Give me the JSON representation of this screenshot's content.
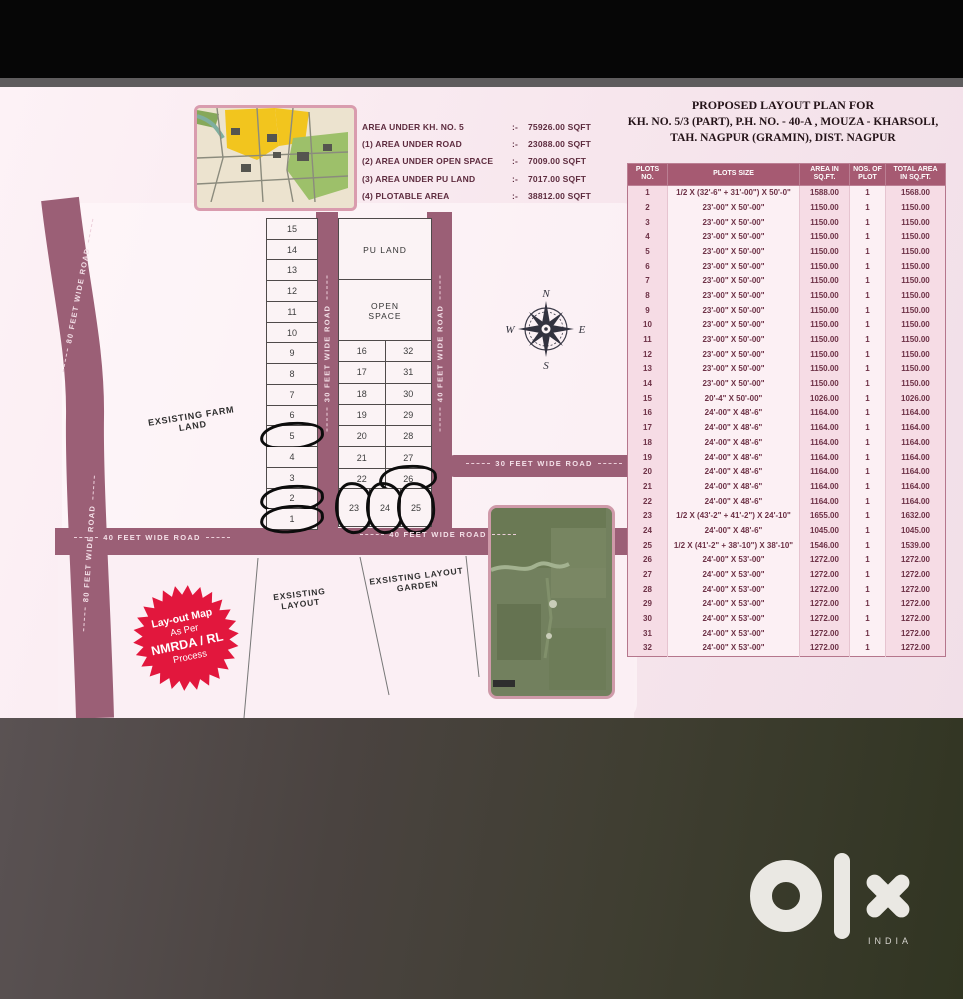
{
  "colors": {
    "road": "#9b5f76",
    "table_header": "#a65a72",
    "badge_red": "#e2173d",
    "plan_background": "#f8e9ef",
    "brand_mark": "#eae8e3"
  },
  "header": {
    "title_line1": "PROPOSED LAYOUT PLAN FOR",
    "title_line2": "KH. NO. 5/3 (PART), P.H. NO. - 40-A , MOUZA - KHARSOLI,",
    "title_line3": "TAH. NAGPUR (GRAMIN), DIST. NAGPUR"
  },
  "area_legend": {
    "sep": ":-",
    "rows": [
      {
        "label": "AREA UNDER KH. NO. 5",
        "value": "75926.00 SQFT"
      },
      {
        "label": "(1) AREA UNDER ROAD",
        "value": "23088.00 SQFT"
      },
      {
        "label": "(2) AREA UNDER OPEN SPACE",
        "value": "7009.00 SQFT"
      },
      {
        "label": "(3) AREA UNDER PU LAND",
        "value": "7017.00 SQFT"
      },
      {
        "label": "(4) PLOTABLE AREA",
        "value": "38812.00 SQFT"
      }
    ]
  },
  "table": {
    "headers": [
      "PLOTS NO.",
      "PLOTS SIZE",
      "AREA IN\nSQ.FT.",
      "NOS. OF\nPLOT",
      "TOTAL AREA\nIN SQ.FT."
    ],
    "rows": [
      [
        "1",
        "1/2 X (32'-6\" + 31'-00\") X 50'-0\"",
        "1588.00",
        "1",
        "1568.00"
      ],
      [
        "2",
        "23'-00\" X 50'-00\"",
        "1150.00",
        "1",
        "1150.00"
      ],
      [
        "3",
        "23'-00\" X 50'-00\"",
        "1150.00",
        "1",
        "1150.00"
      ],
      [
        "4",
        "23'-00\" X 50'-00\"",
        "1150.00",
        "1",
        "1150.00"
      ],
      [
        "5",
        "23'-00\" X 50'-00\"",
        "1150.00",
        "1",
        "1150.00"
      ],
      [
        "6",
        "23'-00\" X 50'-00\"",
        "1150.00",
        "1",
        "1150.00"
      ],
      [
        "7",
        "23'-00\" X 50'-00\"",
        "1150.00",
        "1",
        "1150.00"
      ],
      [
        "8",
        "23'-00\" X 50'-00\"",
        "1150.00",
        "1",
        "1150.00"
      ],
      [
        "9",
        "23'-00\" X 50'-00\"",
        "1150.00",
        "1",
        "1150.00"
      ],
      [
        "10",
        "23'-00\" X 50'-00\"",
        "1150.00",
        "1",
        "1150.00"
      ],
      [
        "11",
        "23'-00\" X 50'-00\"",
        "1150.00",
        "1",
        "1150.00"
      ],
      [
        "12",
        "23'-00\" X 50'-00\"",
        "1150.00",
        "1",
        "1150.00"
      ],
      [
        "13",
        "23'-00\" X 50'-00\"",
        "1150.00",
        "1",
        "1150.00"
      ],
      [
        "14",
        "23'-00\" X 50'-00\"",
        "1150.00",
        "1",
        "1150.00"
      ],
      [
        "15",
        "20'-4\" X 50'-00\"",
        "1026.00",
        "1",
        "1026.00"
      ],
      [
        "16",
        "24'-00\" X 48'-6\"",
        "1164.00",
        "1",
        "1164.00"
      ],
      [
        "17",
        "24'-00\" X 48'-6\"",
        "1164.00",
        "1",
        "1164.00"
      ],
      [
        "18",
        "24'-00\" X 48'-6\"",
        "1164.00",
        "1",
        "1164.00"
      ],
      [
        "19",
        "24'-00\" X 48'-6\"",
        "1164.00",
        "1",
        "1164.00"
      ],
      [
        "20",
        "24'-00\" X 48'-6\"",
        "1164.00",
        "1",
        "1164.00"
      ],
      [
        "21",
        "24'-00\" X 48'-6\"",
        "1164.00",
        "1",
        "1164.00"
      ],
      [
        "22",
        "24'-00\" X 48'-6\"",
        "1164.00",
        "1",
        "1164.00"
      ],
      [
        "23",
        "1/2 X (43'-2\" + 41'-2\") X 24'-10\"",
        "1655.00",
        "1",
        "1632.00"
      ],
      [
        "24",
        "24'-00\" X 48'-6\"",
        "1045.00",
        "1",
        "1045.00"
      ],
      [
        "25",
        "1/2 X (41'-2\" + 38'-10\") X 38'-10\"",
        "1546.00",
        "1",
        "1539.00"
      ],
      [
        "26",
        "24'-00\" X 53'-00\"",
        "1272.00",
        "1",
        "1272.00"
      ],
      [
        "27",
        "24'-00\" X 53'-00\"",
        "1272.00",
        "1",
        "1272.00"
      ],
      [
        "28",
        "24'-00\" X 53'-00\"",
        "1272.00",
        "1",
        "1272.00"
      ],
      [
        "29",
        "24'-00\" X 53'-00\"",
        "1272.00",
        "1",
        "1272.00"
      ],
      [
        "30",
        "24'-00\" X 53'-00\"",
        "1272.00",
        "1",
        "1272.00"
      ],
      [
        "31",
        "24'-00\" X 53'-00\"",
        "1272.00",
        "1",
        "1272.00"
      ],
      [
        "32",
        "24'-00\" X 53'-00\"",
        "1272.00",
        "1",
        "1272.00"
      ]
    ]
  },
  "map": {
    "left_plots": [
      "15",
      "14",
      "13",
      "12",
      "11",
      "10",
      "9",
      "8",
      "7",
      "6",
      "5",
      "4",
      "3",
      "2",
      "1"
    ],
    "mid_left_plots": [
      "16",
      "17",
      "18",
      "19",
      "20",
      "21",
      "22"
    ],
    "mid_right_plots": [
      "32",
      "31",
      "30",
      "29",
      "28",
      "27",
      "26"
    ],
    "bottom_plots": [
      "23",
      "24",
      "25"
    ],
    "circled_plots": [
      "5",
      "2",
      "1",
      "23",
      "24",
      "25",
      "26"
    ],
    "pu_land_label": "PU LAND",
    "open_space_label": "OPEN\nSPACE",
    "farm_land_label": "EXSISTING FARM\nLAND",
    "existing_layout_label": "EXSISTING\nLAYOUT",
    "existing_garden_label": "EXSISTING LAYOUT\nGARDEN",
    "roads": {
      "left_80_upper": "80 FEET WIDE ROAD",
      "left_80_lower": "80 FEET WIDE ROAD",
      "mid_30_vertical": "30 FEET WIDE ROAD",
      "right_40_vertical": "40 FEET WIDE ROAD",
      "stub_30_horizontal": "30 FEET WIDE ROAD",
      "main_40_left": "40 FEET WIDE ROAD",
      "main_40_right": "40 FEET WIDE ROAD"
    },
    "compass": {
      "n": "N",
      "e": "E",
      "s": "S",
      "w": "W"
    },
    "badge": {
      "line1": "Lay-out Map",
      "line2": "As Per",
      "line3": "NMRDA / RL",
      "line4": "Process"
    }
  },
  "footer": {
    "brand": "olx",
    "country": "INDIA"
  }
}
